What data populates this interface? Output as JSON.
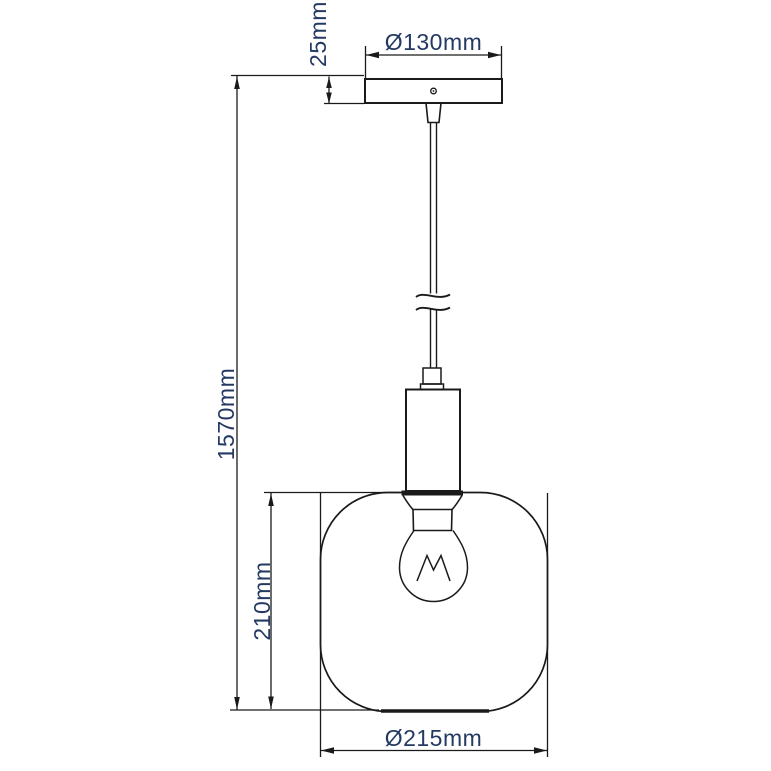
{
  "drawing": {
    "subject": "pendant-lamp-dimension-drawing",
    "dimensions": {
      "canopy_diameter": {
        "label": "Ø130mm",
        "value_mm": 130
      },
      "canopy_height": {
        "label": "25mm",
        "value_mm": 25
      },
      "total_height": {
        "label": "1570mm",
        "value_mm": 1570
      },
      "shade_height": {
        "label": "210mm",
        "value_mm": 210
      },
      "shade_diameter": {
        "label": "Ø215mm",
        "value_mm": 215
      }
    },
    "colors": {
      "background": "#ffffff",
      "line": "#1a1a1a",
      "dimension_text": "#243a63"
    }
  }
}
